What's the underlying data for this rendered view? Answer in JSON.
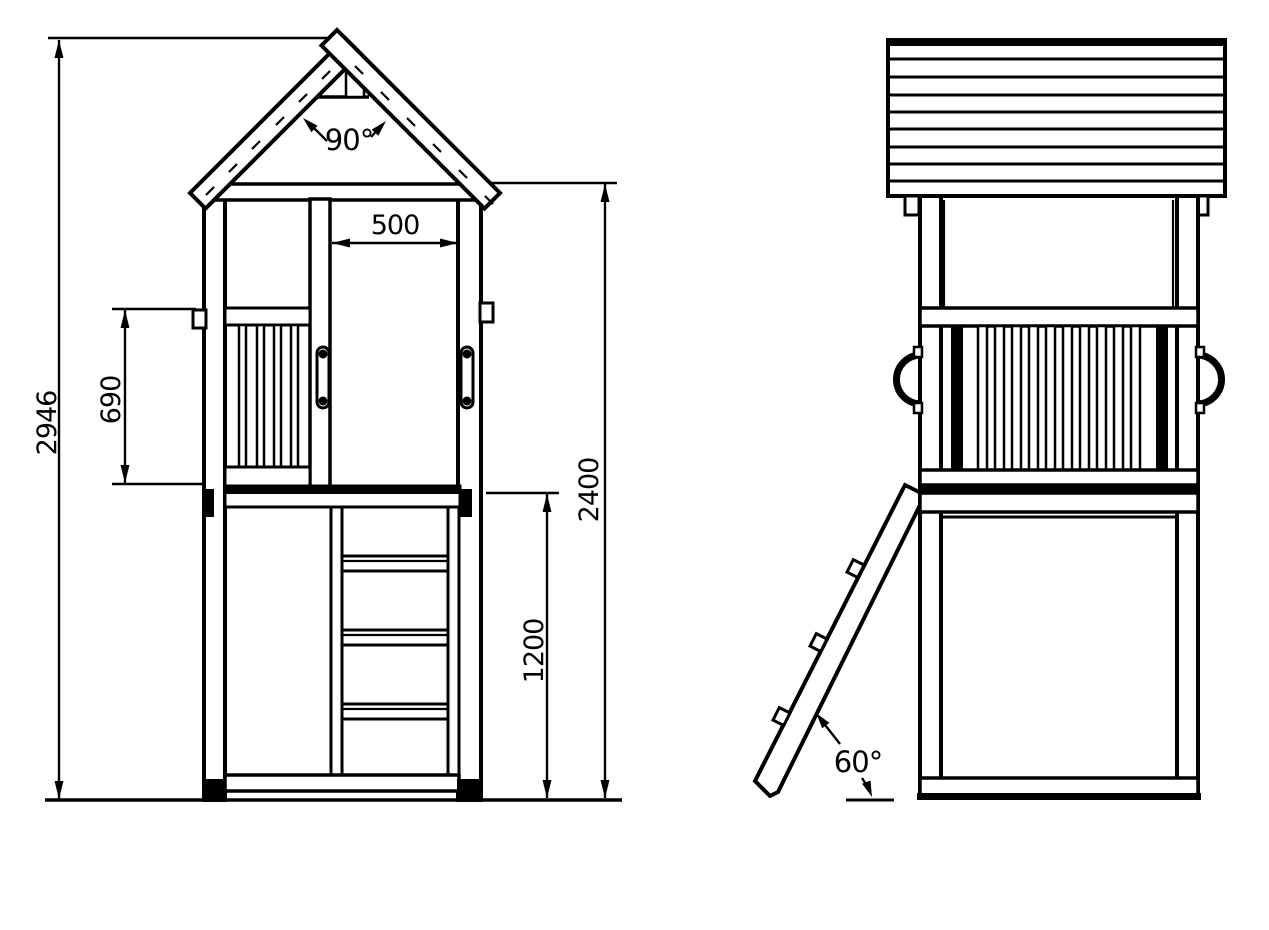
{
  "document": {
    "type": "technical-dimension-drawing",
    "subject": "wooden play tower with gable roof, balustrade and access ladder",
    "colors": {
      "line": "#000000",
      "background": "#ffffff"
    }
  },
  "views": {
    "front": {
      "name": "front-elevation"
    },
    "side": {
      "name": "side-elevation"
    }
  },
  "dimensions": {
    "total_height": "2946",
    "balustrade_height": "690",
    "opening_width": "500",
    "roof_base_height": "2400",
    "platform_height": "1200",
    "roof_apex_angle": "90°",
    "ladder_angle": "60°"
  }
}
